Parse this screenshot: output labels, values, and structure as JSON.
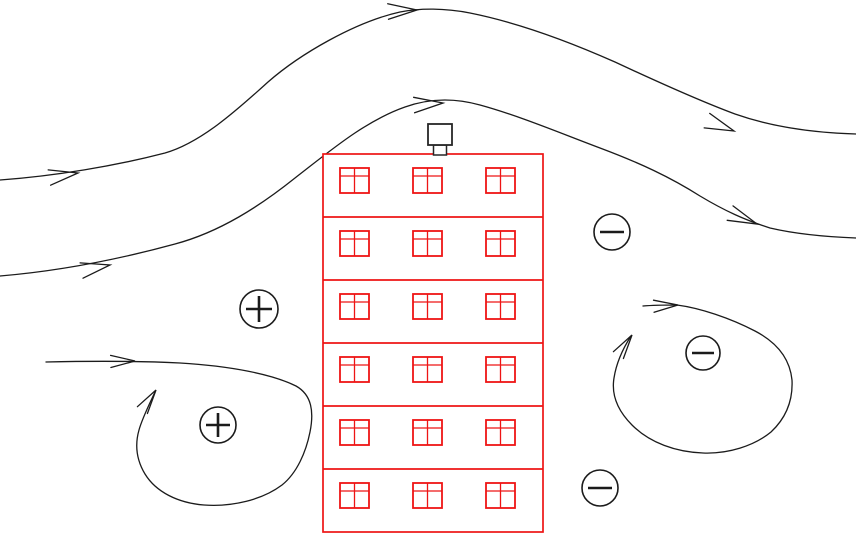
{
  "diagram": {
    "description": "Wind flow pattern and pressure distribution around a tall building",
    "width": 856,
    "height": 543,
    "background_color": "#ffffff",
    "flow_line_color": "#1b1b1b",
    "building_color": "#ee1414",
    "chimney_color": "#262626"
  },
  "building": {
    "x": 323,
    "y": 154,
    "width": 220,
    "height": 378,
    "floors": 6,
    "windows_per_floor": 3,
    "floor_tops": [
      154,
      217,
      280,
      343,
      406,
      469
    ],
    "window_columns_x": [
      340,
      413,
      486
    ],
    "window": {
      "width": 29,
      "height": 25,
      "offset_from_floor_top": 14,
      "sash_bar_offset": 8
    },
    "chimney": {
      "box": {
        "x": 428,
        "y": 124,
        "width": 24,
        "height": 21
      },
      "neck": {
        "x": 433.5,
        "y": 145,
        "width": 13,
        "height": 10
      }
    }
  },
  "streamlines": [
    {
      "name": "upper-streamline",
      "path": "M 0 180 C 55 176 115 166 165 153 C 200 143 235 112 268 82 C 300 54 355 22 400 12 C 420 8 445 8 470 13 C 520 23 570 42 615 62 C 660 83 700 101 735 114 C 775 128 820 133 856 134",
      "arrow_length": 30,
      "arrow_half_angle": 15,
      "arrows": [
        {
          "x": 78,
          "y": 173,
          "angle": -9
        },
        {
          "x": 417,
          "y": 10,
          "angle": -3
        },
        {
          "x": 734,
          "y": 131,
          "angle": 21
        }
      ]
    },
    {
      "name": "lower-streamline",
      "path": "M 0 276 C 60 271 120 259 175 244 C 220 232 260 206 295 178 C 330 151 365 121 405 107 C 430 98 455 98 480 105 C 520 116 560 133 600 148 C 640 163 670 177 700 196 C 725 211 745 220 770 228 C 800 235 830 237 856 238",
      "arrow_length": 30,
      "arrow_half_angle": 15,
      "arrows": [
        {
          "x": 110,
          "y": 265,
          "angle": -11
        },
        {
          "x": 443,
          "y": 103,
          "angle": -4
        },
        {
          "x": 757,
          "y": 224,
          "angle": 22
        }
      ]
    }
  ],
  "vortices": [
    {
      "name": "windward-ground-vortex",
      "path": "M 46 362 C 90 361 140 361 180 363 C 230 366 272 374 296 386 C 312 395 314 412 310 432 C 306 452 297 473 282 485 C 262 500 232 507 204 505 C 178 503 156 492 145 474 C 136 459 135 444 139 430 C 142 419 148 407 155 392",
      "arrow_length": 25,
      "arrow_half_angle": 14,
      "arrows": [
        {
          "x": 135,
          "y": 361,
          "angle": -1
        },
        {
          "x": 156,
          "y": 390,
          "angle": -56
        }
      ]
    },
    {
      "name": "leeward-wake-vortex",
      "path": "M 643 306 C 655 305 668 305 677 305 C 700 308 730 318 755 331 C 778 343 790 360 792 380 C 793 400 786 418 771 432 C 754 446 728 454 703 453 C 676 452 650 443 632 425 C 618 411 611 396 614 378 C 616 365 622 350 631 336",
      "arrow_length": 25,
      "arrow_half_angle": 14,
      "arrows": [
        {
          "x": 678,
          "y": 305,
          "angle": -3
        },
        {
          "x": 632,
          "y": 335,
          "angle": -56
        }
      ]
    }
  ],
  "pressure_markers": [
    {
      "symbol": "+",
      "meaning": "positive-pressure",
      "x": 259,
      "y": 309,
      "radius": 19
    },
    {
      "symbol": "+",
      "meaning": "positive-pressure",
      "x": 218,
      "y": 425,
      "radius": 18
    },
    {
      "symbol": "-",
      "meaning": "negative-pressure",
      "x": 612,
      "y": 232,
      "radius": 18
    },
    {
      "symbol": "-",
      "meaning": "negative-pressure",
      "x": 703,
      "y": 353,
      "radius": 17
    },
    {
      "symbol": "-",
      "meaning": "negative-pressure",
      "x": 600,
      "y": 488,
      "radius": 18
    }
  ]
}
